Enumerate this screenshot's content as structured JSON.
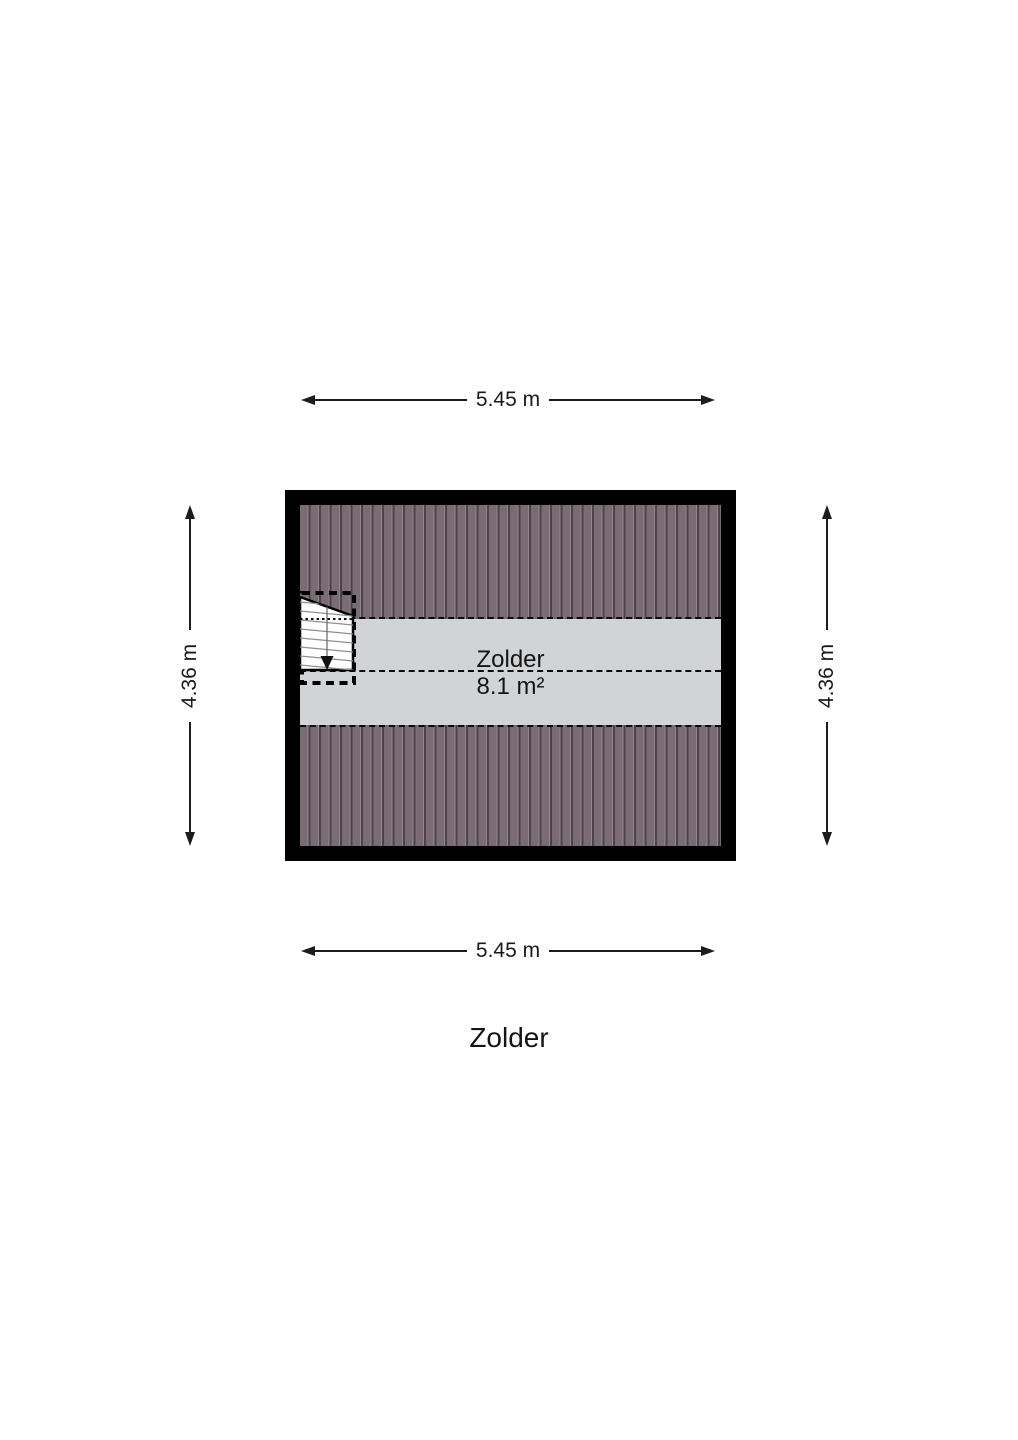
{
  "title": "Zolder",
  "room": {
    "name": "Zolder",
    "area": "8.1 m²"
  },
  "dimensions": {
    "top": "5.45 m",
    "bottom": "5.45 m",
    "left": "4.36 m",
    "right": "4.36 m"
  },
  "icons": {
    "stair_direction": "stair-down-arrow"
  },
  "colors": {
    "wall": "#000000",
    "roof_hatch": "#7b6c74",
    "floor": "#d2d3d4",
    "background": "#ffffff",
    "line": "#1c1c1c"
  }
}
